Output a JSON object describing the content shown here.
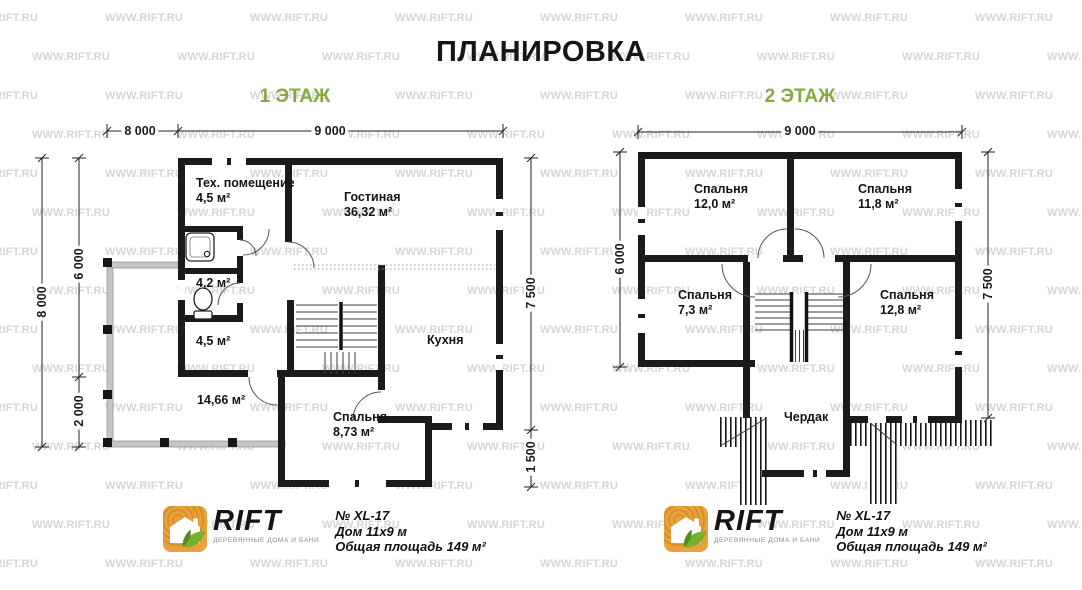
{
  "title": "ПЛАНИРОВКА",
  "watermark": "WWW.RIFT.RU",
  "floor1": {
    "heading": "1 ЭТАЖ",
    "rooms": {
      "tech": {
        "name": "Тех. помещение",
        "area": "4,5 м²"
      },
      "living": {
        "name": "Гостиная",
        "area": "36,32 м²"
      },
      "wc": {
        "area": "4,2 м²"
      },
      "hall": {
        "area": "4,5 м²"
      },
      "kitchen": {
        "name": "Кухня"
      },
      "terrace": {
        "area": "14,66 м²"
      },
      "bedroom": {
        "name": "Спальня",
        "area": "8,73 м²"
      }
    },
    "dims": {
      "top_left": "8 000",
      "top_main": "9 000",
      "left_full": "8 000",
      "left_upper": "6 000",
      "left_lower": "2 000",
      "right_main": "7 500",
      "right_lower": "1 500"
    }
  },
  "floor2": {
    "heading": "2 ЭТАЖ",
    "rooms": {
      "bedroom1": {
        "name": "Спальня",
        "area": "12,0 м²"
      },
      "bedroom2": {
        "name": "Спальня",
        "area": "11,8 м²"
      },
      "bedroom3": {
        "name": "Спальня",
        "area": "7,3 м²"
      },
      "bedroom4": {
        "name": "Спальня",
        "area": "12,8 м²"
      },
      "attic": {
        "name": "Чердак"
      }
    },
    "dims": {
      "top_main": "9 000",
      "left_main": "6 000",
      "right_main": "7 500"
    }
  },
  "logo": {
    "brand": "RIFT",
    "tagline": "ДЕРЕВЯННЫЕ ДОМА И БАНИ"
  },
  "specs": {
    "model": "№ XL-17",
    "house": "Дом 11х9 м",
    "total": "Общая площадь 149 м²"
  },
  "colors": {
    "accent_green": "#86a93e",
    "logo_orange": "#e9a23b",
    "wall": "#1b1b1b",
    "watermark": "#d6d6d6"
  }
}
